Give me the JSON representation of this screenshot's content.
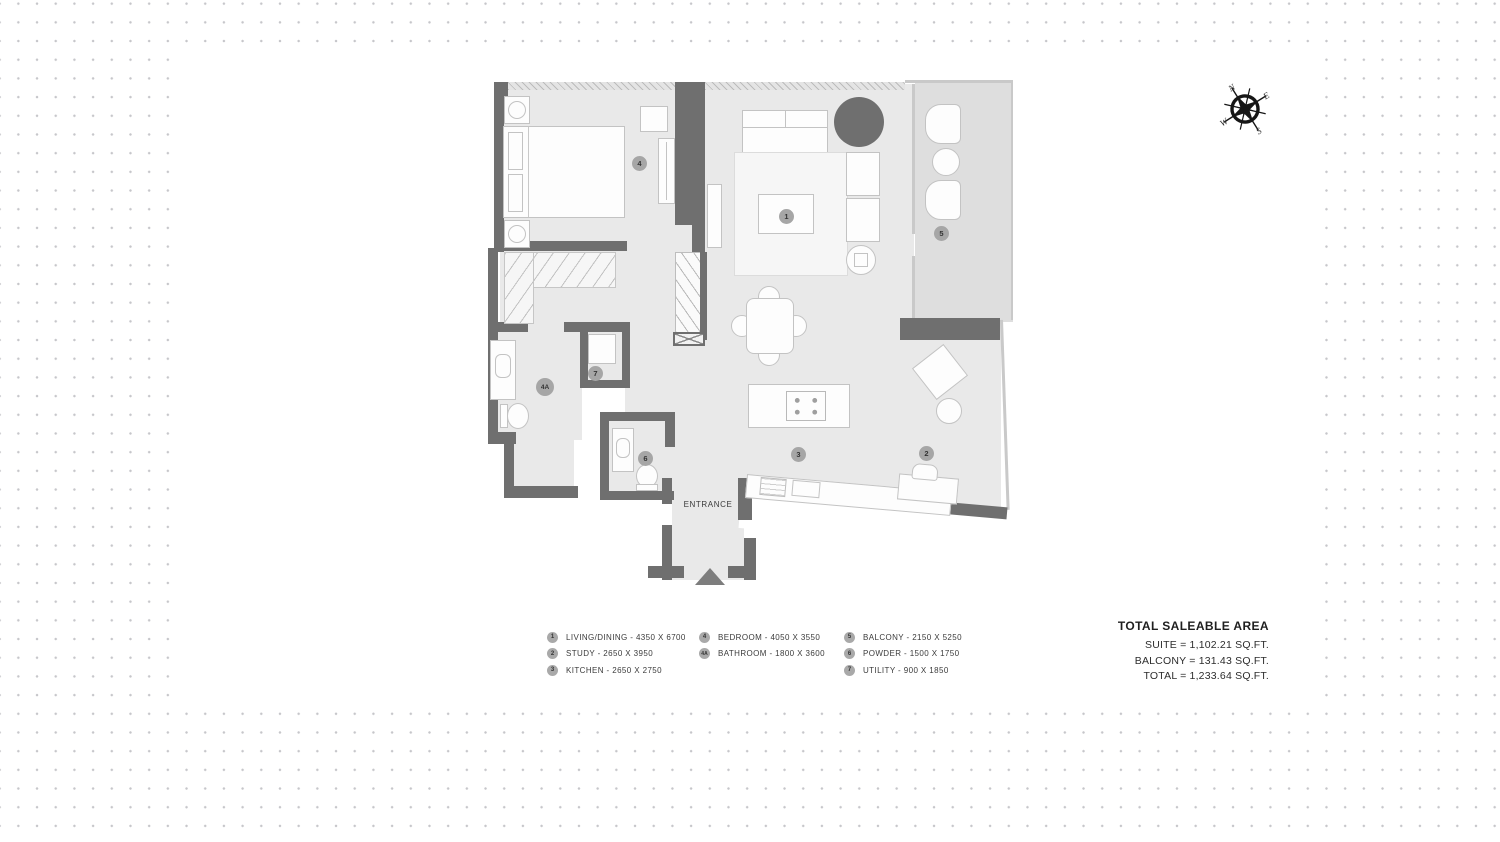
{
  "plan": {
    "entrance_label": "ENTRANCE",
    "markers": [
      {
        "id": "1",
        "room": "Living/Dining"
      },
      {
        "id": "2",
        "room": "Study"
      },
      {
        "id": "3",
        "room": "Kitchen"
      },
      {
        "id": "4",
        "room": "Bedroom"
      },
      {
        "id": "4A",
        "room": "Bathroom"
      },
      {
        "id": "5",
        "room": "Balcony"
      },
      {
        "id": "6",
        "room": "Powder"
      },
      {
        "id": "7",
        "room": "Utility"
      }
    ]
  },
  "legend": {
    "columns": [
      {
        "items": [
          {
            "id": "1",
            "label": "LIVING/DINING - 4350 X 6700"
          },
          {
            "id": "2",
            "label": "STUDY - 2650 X 3950"
          },
          {
            "id": "3",
            "label": "KITCHEN - 2650 X 2750"
          }
        ]
      },
      {
        "items": [
          {
            "id": "4",
            "label": "BEDROOM - 4050 X 3550"
          },
          {
            "id": "4A",
            "label": "BATHROOM - 1800 X 3600"
          }
        ]
      },
      {
        "items": [
          {
            "id": "5",
            "label": "BALCONY - 2150 X 5250"
          },
          {
            "id": "6",
            "label": "POWDER - 1500 X 1750"
          },
          {
            "id": "7",
            "label": "UTILITY - 900 X 1850"
          }
        ]
      }
    ]
  },
  "totals": {
    "title": "TOTAL SALEABLE AREA",
    "lines": [
      "SUITE = 1,102.21 SQ.FT.",
      "BALCONY = 131.43 SQ.FT.",
      "TOTAL = 1,233.64 SQ.FT."
    ]
  },
  "compass": {
    "n": "N",
    "e": "E",
    "s": "S",
    "w": "W"
  },
  "colors": {
    "wall": "#6f6f6f",
    "floor": "#e9e9e9",
    "balcony_floor": "#dedede",
    "accent_dark_circle": "#6f6f6f",
    "marker": "#a6a6a6",
    "dot_grid": "#c6c6ca"
  }
}
